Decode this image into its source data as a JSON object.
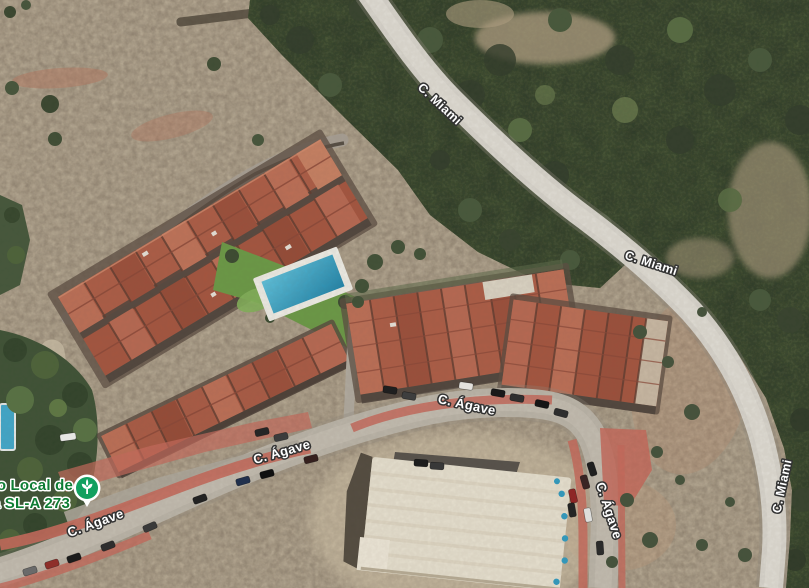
{
  "map": {
    "type": "satellite",
    "poi": {
      "label_line1": "ero Local de",
      "label_line2": "ta SL-A 273",
      "icon": "plant-nursery-icon",
      "marker_color": "#12a05f",
      "label_color": "#0e7d34"
    },
    "road_labels": {
      "miami_top": "C. Miami",
      "miami_mid": "C. Miami",
      "miami_right": "C. Miami",
      "agave_sw": "C. Ágave",
      "agave_west": "C. Ágave",
      "agave_main": "C. Ágave",
      "agave_south": "C. Ágave"
    },
    "colors": {
      "scrub_terrain": "#a99b86",
      "forest_green": "#3c4a33",
      "miami_road_surface": "#dad7cf",
      "agave_street_surface": "#bcb6aa",
      "red_curb_paving": "#c7695b",
      "terracotta_roof": "#b06049",
      "pool_blue": "#3fa9cd",
      "lawn_green": "#6a9a45",
      "label_fill": "#ffffff",
      "label_outline": "#333333"
    }
  }
}
